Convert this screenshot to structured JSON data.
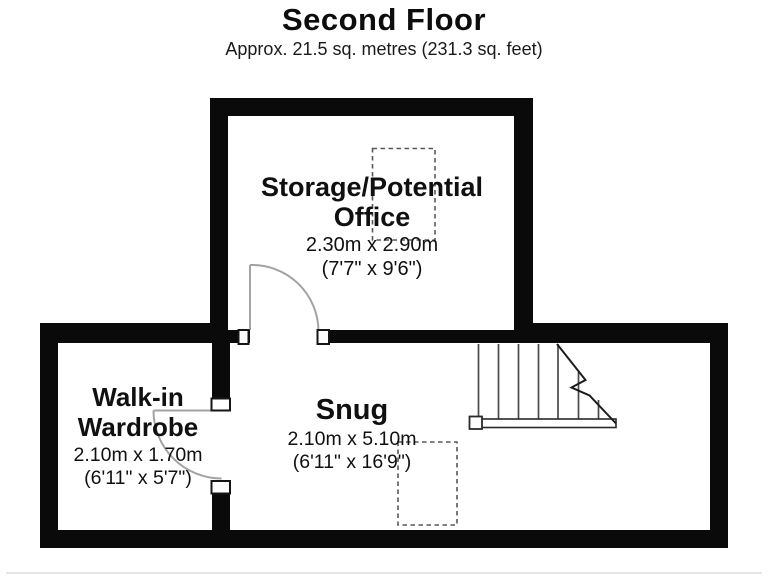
{
  "page": {
    "title": "Second Floor",
    "subtitle": "Approx. 21.5 sq. metres (231.3 sq. feet)"
  },
  "rooms": [
    {
      "name_lines": [
        "Storage/Potential",
        "Office"
      ],
      "dims_metric": "2.30m x 2.90m",
      "dims_imperial": "(7'7\" x 9'6\")"
    },
    {
      "name_lines": [
        "Walk-in",
        "Wardrobe"
      ],
      "dims_metric": "2.10m x 1.70m",
      "dims_imperial": "(6'11\" x 5'7\")"
    },
    {
      "name_lines": [
        "Snug"
      ],
      "dims_metric": "2.10m x 5.10m",
      "dims_imperial": "(6'11\" x 16'9\")"
    }
  ],
  "colors": {
    "wall": "#0a0a0a",
    "floor": "#ffffff",
    "door_arc": "#a3a3a3",
    "stair_tread": "#4a4a4a",
    "break_line": "#1c1c1c",
    "dashed_area": "#585858"
  }
}
